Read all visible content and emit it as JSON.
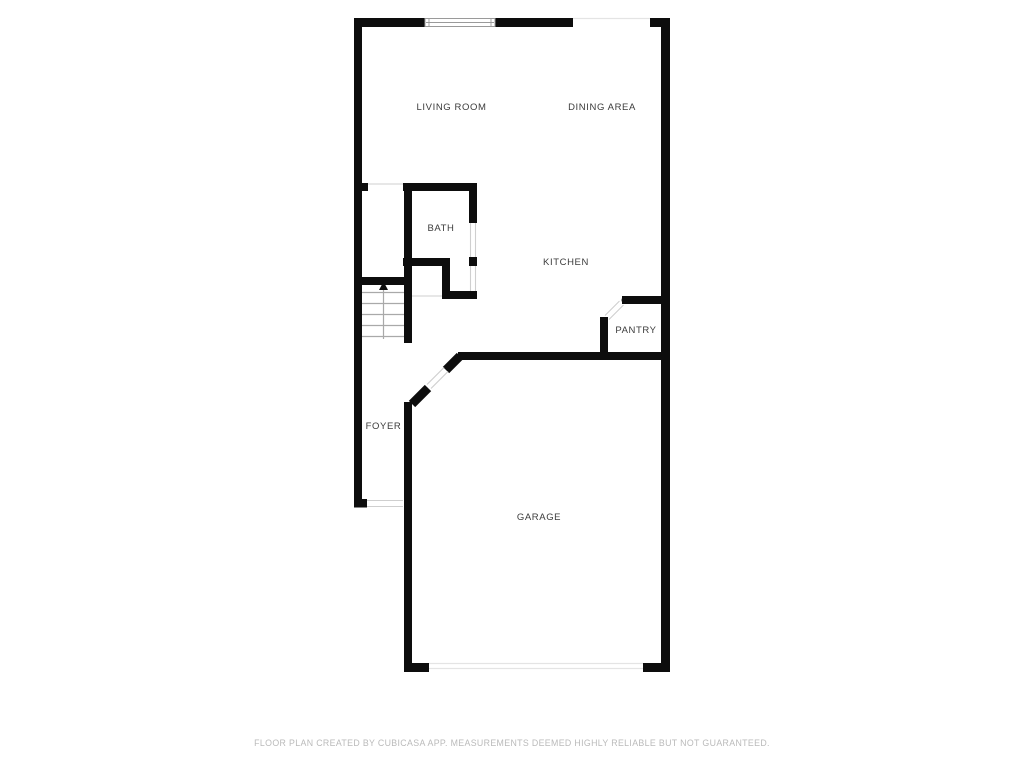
{
  "colors": {
    "wall": "#0d0d0d",
    "label": "#3b3b3b",
    "footer": "#bababa",
    "opening": "#cfcfcf",
    "faint": "#e4e4e4",
    "step": "#a9a9a9",
    "frame": "#9a9a9a",
    "background": "#ffffff"
  },
  "rooms": {
    "living_room": {
      "label": "LIVING ROOM"
    },
    "dining_area": {
      "label": "DINING AREA"
    },
    "bath": {
      "label": "BATH"
    },
    "kitchen": {
      "label": "KITCHEN"
    },
    "pantry": {
      "label": "PANTRY"
    },
    "foyer": {
      "label": "FOYER"
    },
    "garage": {
      "label": "GARAGE"
    }
  },
  "stairs": {
    "direction": "up",
    "step_count": 5
  },
  "footer": {
    "disclaimer": "FLOOR PLAN CREATED BY CUBICASA APP. MEASUREMENTS DEEMED HIGHLY RELIABLE BUT NOT GUARANTEED."
  }
}
